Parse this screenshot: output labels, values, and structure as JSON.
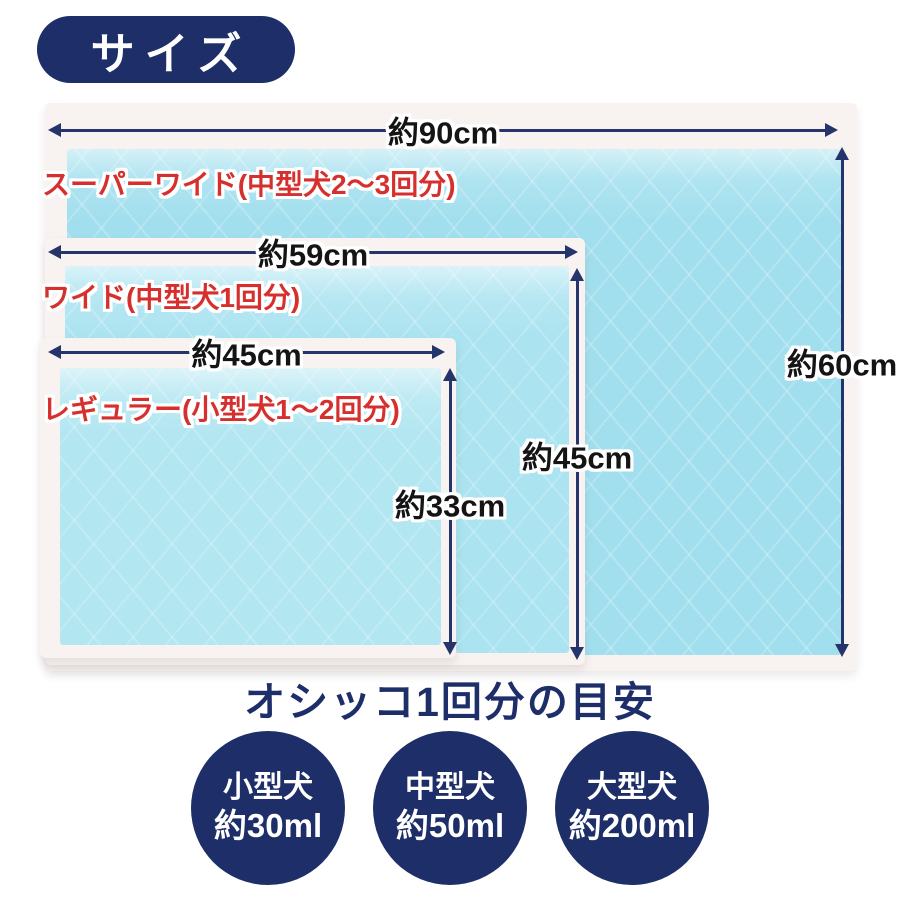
{
  "badge": {
    "label": "サイズ"
  },
  "pads": [
    {
      "name": "スーパーワイド(中型犬2～3回分)",
      "width": "約90cm",
      "height": "約60cm"
    },
    {
      "name": "ワイド(中型犬1回分)",
      "width": "約59cm",
      "height": "約45cm"
    },
    {
      "name": "レギュラー(小型犬1～2回分)",
      "width": "約45cm",
      "height": "約33cm"
    }
  ],
  "guide": {
    "title": "オシッコ1回分の目安",
    "items": [
      {
        "dog": "小型犬",
        "amount": "約30ml"
      },
      {
        "dog": "中型犬",
        "amount": "約50ml"
      },
      {
        "dog": "大型犬",
        "amount": "約200ml"
      }
    ]
  },
  "colors": {
    "navy": "#1d2e69",
    "red": "#d5302e",
    "arrow_navy": "#25356c",
    "pad_blue": "#abe3f0",
    "pad_border_white": "#f8f2f0"
  }
}
